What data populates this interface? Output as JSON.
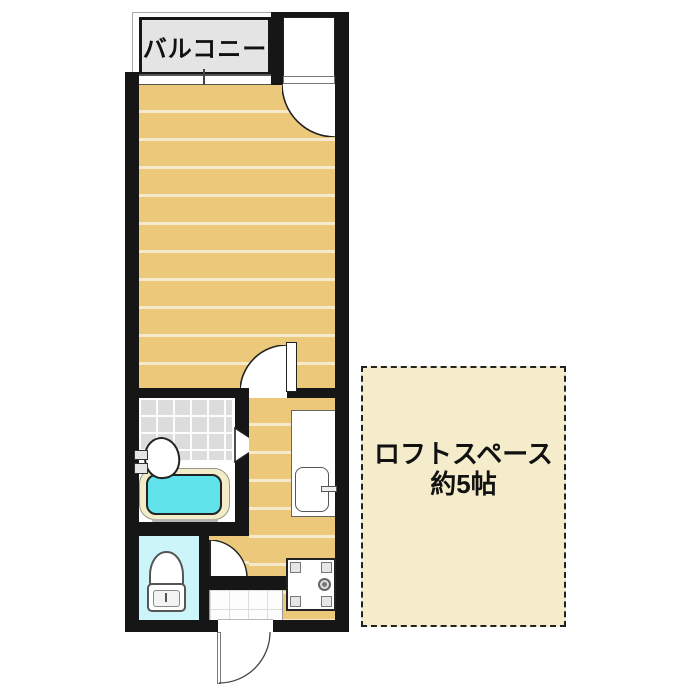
{
  "floorplan": {
    "labels": {
      "balcony": "バルコニー",
      "loft_line1": "ロフトスペース",
      "loft_line2": "約5帖"
    },
    "colors": {
      "wall": "#161616",
      "wood_floor": "#ebc87a",
      "floor_stripe": "#f7e9c0",
      "balcony_fill": "#e4e4e4",
      "bath_tile": "#dcdcdc",
      "bathtub_water": "#5fe2ea",
      "bathtub_rim": "#f2ecc8",
      "toilet_room_fill": "#cbf5f9",
      "loft_fill": "#f4ecca"
    }
  }
}
